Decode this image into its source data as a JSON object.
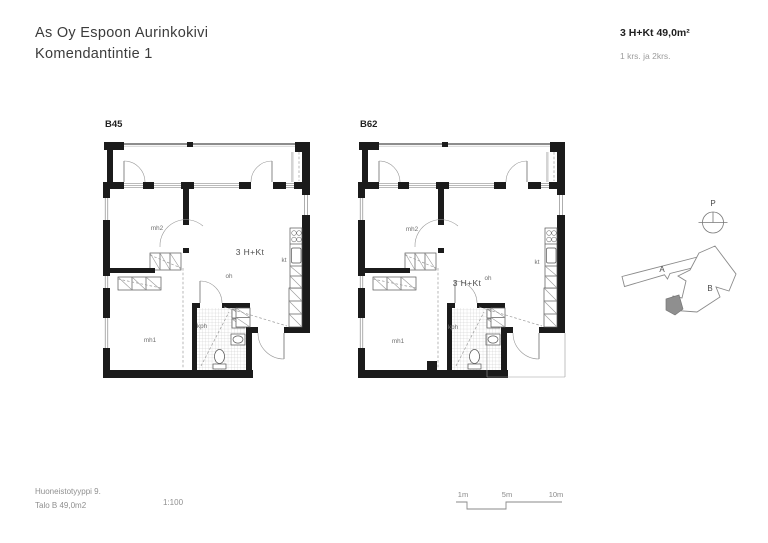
{
  "header": {
    "project_name": "As Oy Espoon Aurinkokivi",
    "address": "Komendantintie 1",
    "apartment_type": "3 H+Kt 49,0m²",
    "floors": "1 krs. ja 2krs."
  },
  "plans": [
    {
      "label": "B45",
      "type_label": "3 H+Kt",
      "rooms": {
        "mh1": "mh1",
        "mh2": "mh2",
        "oh": "oh",
        "kt": "kt",
        "kph": "kph"
      }
    },
    {
      "label": "B62",
      "type_label": "3 H+Kt",
      "rooms": {
        "mh1": "mh1",
        "mh2": "mh2",
        "oh": "oh",
        "kt": "kt",
        "kph": "kph"
      }
    }
  ],
  "site_plan": {
    "north_label": "P",
    "building_a_label": "A",
    "building_b_label": "B",
    "marker_color": "#8f8f8f"
  },
  "scale_bar": {
    "labels": [
      "1m",
      "5m",
      "10m"
    ]
  },
  "footer": {
    "unit_type": "Huoneistotyyppi 9.",
    "building_area": "Talo B 49,0m2",
    "scale": "1:100"
  }
}
